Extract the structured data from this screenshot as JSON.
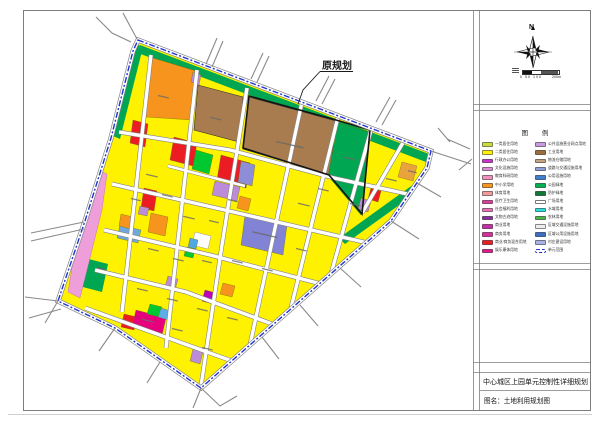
{
  "annotation": {
    "original_plan_label": "原规划"
  },
  "north": {
    "label": "N"
  },
  "scale": {
    "ticks": "0 50 100",
    "end": "200m"
  },
  "legend": {
    "title": "图 例",
    "columns": {
      "left": [
        {
          "label": "一类居住用地",
          "color": "#C8DC3C"
        },
        {
          "label": "二类居住用地",
          "color": "#FFF200"
        },
        {
          "label": "行政办公用地",
          "color": "#CC33CC"
        },
        {
          "label": "文化设施用地",
          "color": "#DA8FD8"
        },
        {
          "label": "教育科研用地",
          "color": "#F191BD"
        },
        {
          "label": "中小学用地",
          "color": "#F7941D"
        },
        {
          "label": "体育用地",
          "color": "#F29B9B"
        },
        {
          "label": "医疗卫生用地",
          "color": "#E03C9C"
        },
        {
          "label": "社会福利用地",
          "color": "#EE6FB4"
        },
        {
          "label": "文物古迹用地",
          "color": "#8A2F9E"
        },
        {
          "label": "商业用地",
          "color": "#C42FA5"
        },
        {
          "label": "商务用地",
          "color": "#D62F9B"
        },
        {
          "label": "商业/商务混合用地",
          "color": "#EC1C24"
        },
        {
          "label": "娱乐康体用地",
          "color": "#E2188C"
        }
      ],
      "right": [
        {
          "label": "公共设施营业网点用地",
          "color": "#C89BE1"
        },
        {
          "label": "工业用地",
          "color": "#9E6B3B"
        },
        {
          "label": "物流仓储用地",
          "color": "#C8A47E"
        },
        {
          "label": "道路与交通设施用地",
          "color": "#8F9FD8"
        },
        {
          "label": "公用设施用地",
          "color": "#3F7FD0"
        },
        {
          "label": "公园绿地",
          "color": "#00B050"
        },
        {
          "label": "防护绿地",
          "color": "#0E7A35"
        },
        {
          "label": "广场用地",
          "color": "#FFFFFF",
          "border": true
        },
        {
          "label": "水域用地",
          "color": "#27E0E0"
        },
        {
          "label": "农林用地",
          "color": "#4CB648"
        },
        {
          "label": "区域交通设施用地",
          "color": "#EDEDED"
        },
        {
          "label": "区域公用设施用地",
          "color": "#3A6FC4"
        },
        {
          "label": "村庄建设用地",
          "color": "#A8B4E8"
        },
        {
          "label": "单元范围",
          "type": "dashed"
        }
      ]
    }
  },
  "titleblock": {
    "line1": "中心城区上园单元控制性详细规划",
    "line2": "图名：土地利用规划图"
  },
  "map": {
    "base_color": "#FFF200",
    "unit_boundary_color": "#2233CC"
  }
}
